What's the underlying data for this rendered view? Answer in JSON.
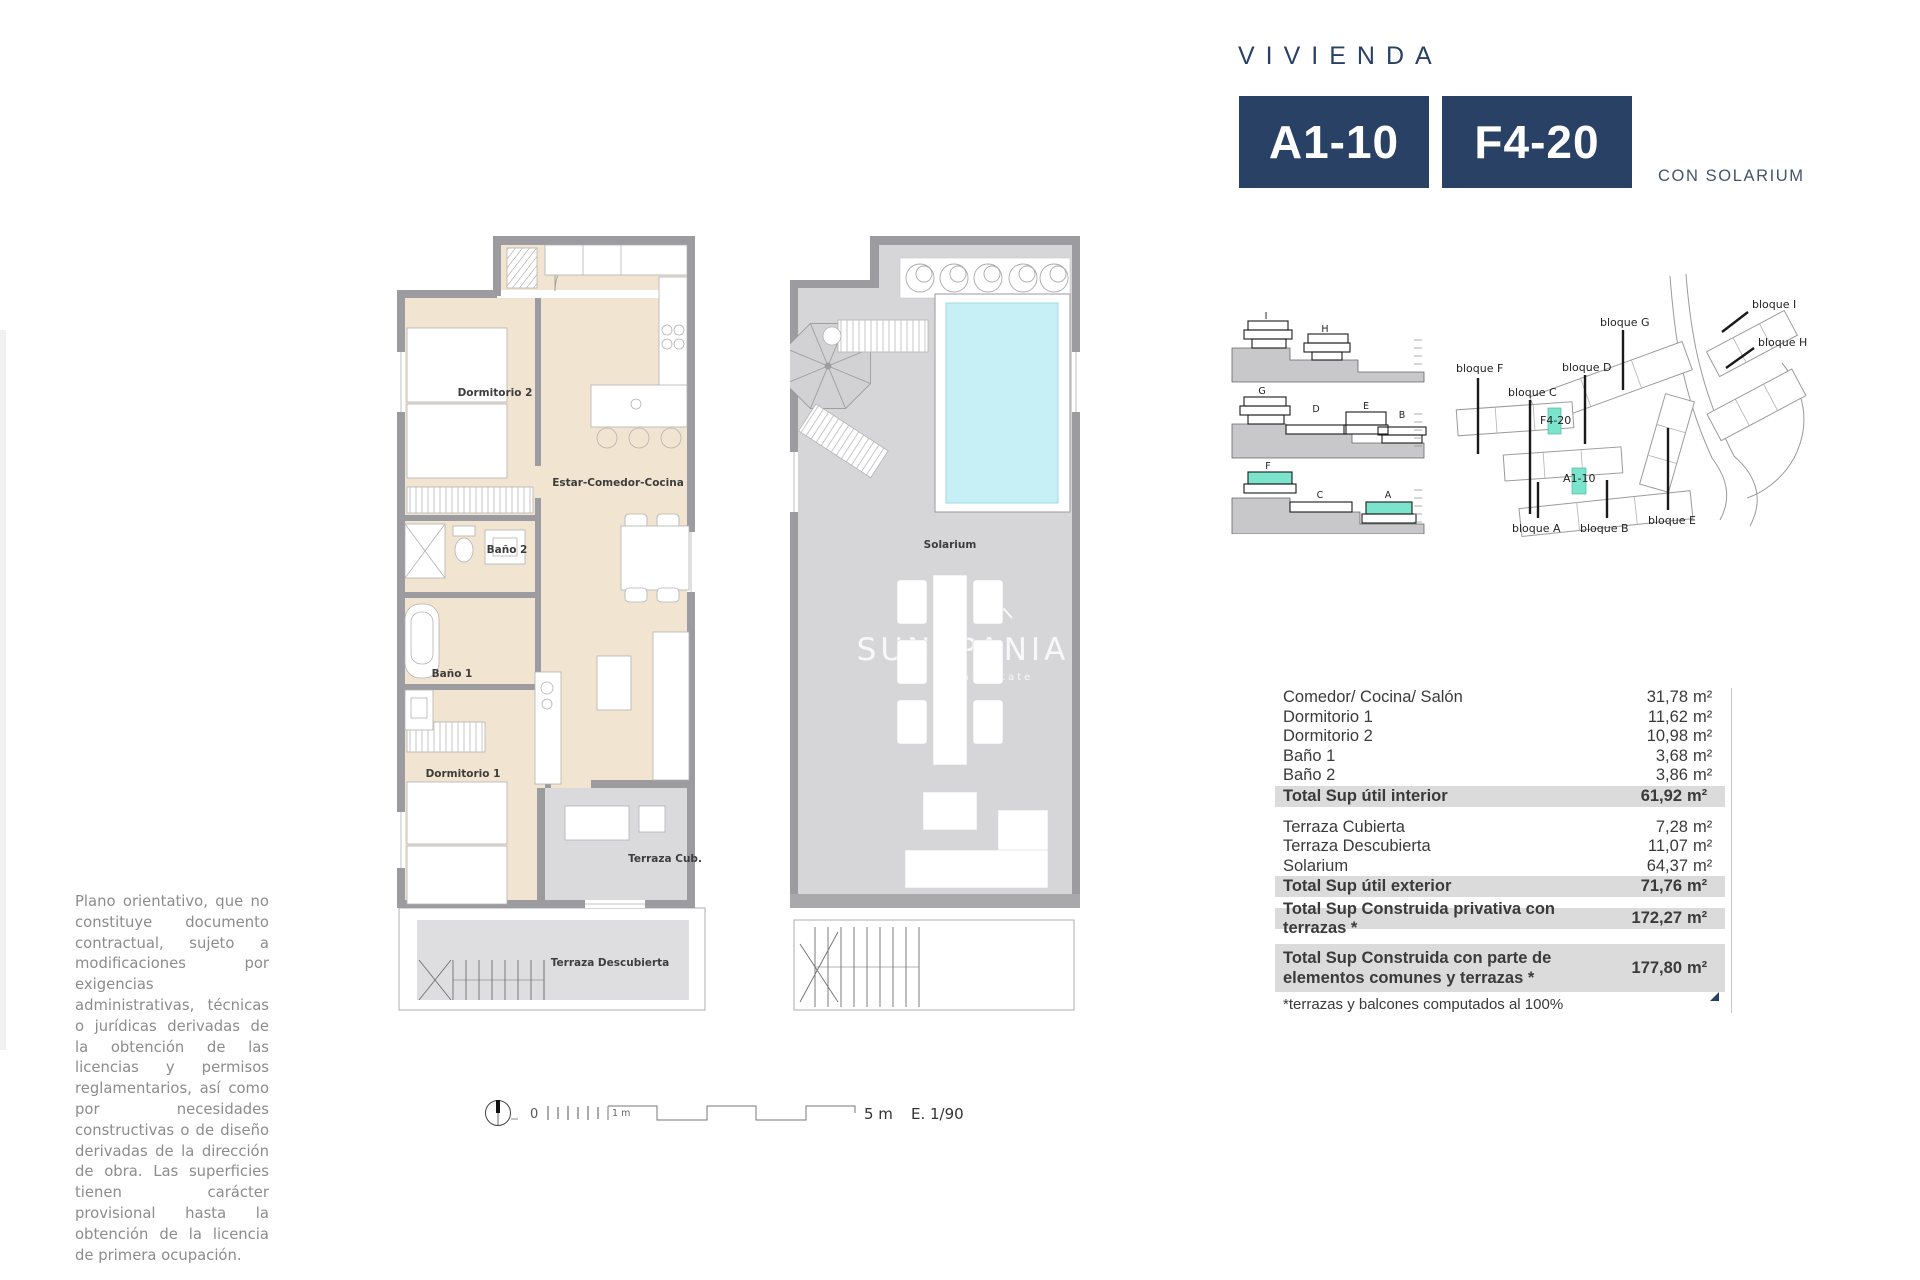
{
  "header": {
    "eyebrow": "VIVIENDA",
    "unit_primary": "A1-10",
    "unit_secondary": "F4-20",
    "variant": "CON SOLARIUM"
  },
  "colors": {
    "navy": "#2a4166",
    "teal": "#7ce3cc",
    "pool": "#c7f0f6"
  },
  "plans": {
    "interior": {
      "dormitorio2": "Dormitorio 2",
      "estar_comedor_cocina": "Estar-Comedor-Cocina",
      "bano2": "Baño 2",
      "bano1": "Baño 1",
      "dormitorio1": "Dormitorio 1",
      "terraza_cub": "Terraza Cub.",
      "terraza_descubierta": "Terraza Descubierta"
    },
    "solarium": {
      "label": "Solarium"
    },
    "watermark": {
      "text": "SUNSPANIA",
      "subtext": "real estate"
    }
  },
  "scale_bar": {
    "zero": "0",
    "one_meter": "1 m",
    "five_meters": "5 m",
    "scale": "E. 1/90"
  },
  "section_diagram": {
    "row1": [
      "I",
      "H"
    ],
    "row2": [
      "G",
      "D",
      "E",
      "B"
    ],
    "row3": [
      "F",
      "C",
      "A"
    ]
  },
  "site_plan": {
    "bloque_i": "bloque I",
    "bloque_h": "bloque H",
    "bloque_g": "bloque G",
    "bloque_d": "bloque D",
    "bloque_f": "bloque F",
    "bloque_c": "bloque C",
    "bloque_a": "bloque A",
    "bloque_b": "bloque B",
    "bloque_e": "bloque E",
    "unit_f": "F4-20",
    "unit_a": "A1-10"
  },
  "areas": {
    "unit": "m²",
    "interior_rows": [
      {
        "label": "Comedor/ Cocina/ Salón",
        "value": "31,78"
      },
      {
        "label": "Dormitorio 1",
        "value": "11,62"
      },
      {
        "label": "Dormitorio 2",
        "value": "10,98"
      },
      {
        "label": "Baño 1",
        "value": "3,68"
      },
      {
        "label": "Baño 2",
        "value": "3,86"
      }
    ],
    "interior_total": {
      "label": "Total Sup útil interior",
      "value": "61,92"
    },
    "exterior_rows": [
      {
        "label": "Terraza Cubierta",
        "value": "7,28"
      },
      {
        "label": "Terraza Descubierta",
        "value": "11,07"
      },
      {
        "label": "Solarium",
        "value": "64,37"
      }
    ],
    "exterior_total": {
      "label": "Total Sup útil exterior",
      "value": "71,76"
    },
    "built_private": {
      "label": "Total Sup Construida privativa con terrazas *",
      "value": "172,27"
    },
    "built_common": {
      "label": "Total Sup Construida con parte de elementos comunes y terrazas *",
      "value": "177,80"
    },
    "footnote": "*terrazas y balcones computados al 100%"
  },
  "disclaimer": "Plano orientativo, que no constituye documento contractual, sujeto a modificaciones por exigencias administrativas, técnicas o jurídicas derivadas de la obtención de las licencias y permisos reglamentarios, así como por necesidades constructivas o de diseño derivadas de la dirección de obra. Las superficies tienen carácter provisional hasta la obtención de la licencia de primera ocupación."
}
